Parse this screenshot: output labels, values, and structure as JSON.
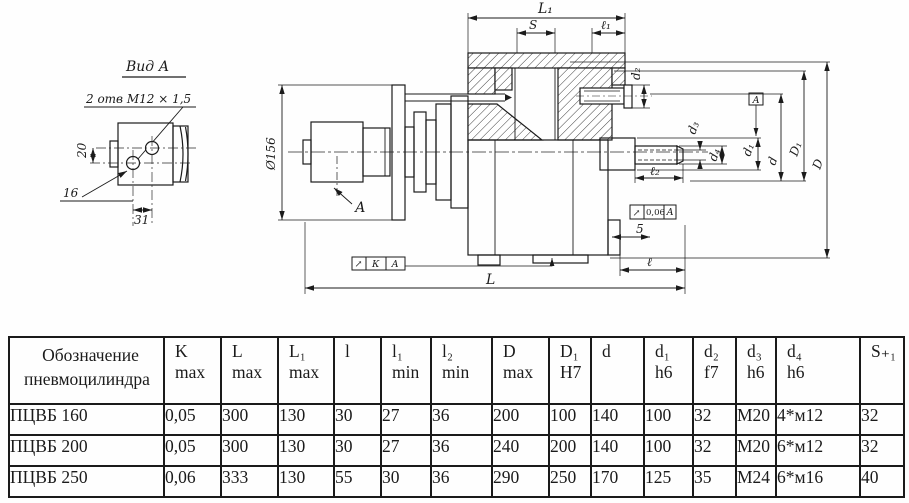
{
  "drawing": {
    "view_a": {
      "title": "Вид А",
      "holes_note": "2 отв  М12 × 1,5",
      "dim_vertical": "20",
      "dim_offset": "16",
      "dim_spacing": "31"
    },
    "main": {
      "dia_flange": "Ø156",
      "dim_L1": "L₁",
      "dim_S": "S",
      "dim_l1": "ℓ₁",
      "dim_d2": "d₂",
      "dim_d3": "d₃",
      "dim_d4": "d₄",
      "dim_d1": "d₁",
      "dim_d": "d",
      "dim_D1": "D₁",
      "dim_D": "D",
      "dim_l2": "ℓ₂",
      "dim_5": "5",
      "dim_l": "ℓ",
      "dim_L": "L",
      "view_arrow_label": "А",
      "datum_label": "А",
      "tolerance_frame_1": {
        "symbol": "↗",
        "value": "К",
        "datum": "А"
      },
      "tolerance_frame_2": {
        "symbol": "↗",
        "value": "0,06",
        "datum": "А"
      }
    }
  },
  "table": {
    "columns": [
      {
        "label": "Обозначение",
        "sub": "пневмоцилиндра"
      },
      {
        "label": "K",
        "sub": "max"
      },
      {
        "label": "L",
        "sub": "max"
      },
      {
        "label": "L₁",
        "sub": "max"
      },
      {
        "label": "l",
        "sub": ""
      },
      {
        "label": "l₁",
        "sub": "min"
      },
      {
        "label": "l₂",
        "sub": "min"
      },
      {
        "label": "D",
        "sub": "max"
      },
      {
        "label": "D₁",
        "sub": "H7"
      },
      {
        "label": "d",
        "sub": ""
      },
      {
        "label": "d₁",
        "sub": "h6"
      },
      {
        "label": "d₂",
        "sub": "f7"
      },
      {
        "label": "d₃",
        "sub": "h6"
      },
      {
        "label": "d₄",
        "sub": "h6"
      },
      {
        "label": "S₊₁",
        "sub": ""
      }
    ],
    "col_widths": [
      155,
      57,
      57,
      56,
      47,
      50,
      61,
      57,
      42,
      53,
      49,
      43,
      40,
      84,
      44
    ],
    "rows": [
      [
        "ПЦВБ 160",
        "0,05",
        "300",
        "130",
        "30",
        "27",
        "36",
        "200",
        "100",
        "140",
        "100",
        "32",
        "М20",
        "4*м12",
        "32"
      ],
      [
        "ПЦВБ 200",
        "0,05",
        "300",
        "130",
        "30",
        "27",
        "36",
        "240",
        "200",
        "140",
        "100",
        "32",
        "М20",
        "6*м12",
        "32"
      ],
      [
        "ПЦВБ 250",
        "0,06",
        "333",
        "130",
        "55",
        "30",
        "36",
        "290",
        "250",
        "170",
        "125",
        "35",
        "М24",
        "6*м16",
        "40"
      ]
    ]
  }
}
